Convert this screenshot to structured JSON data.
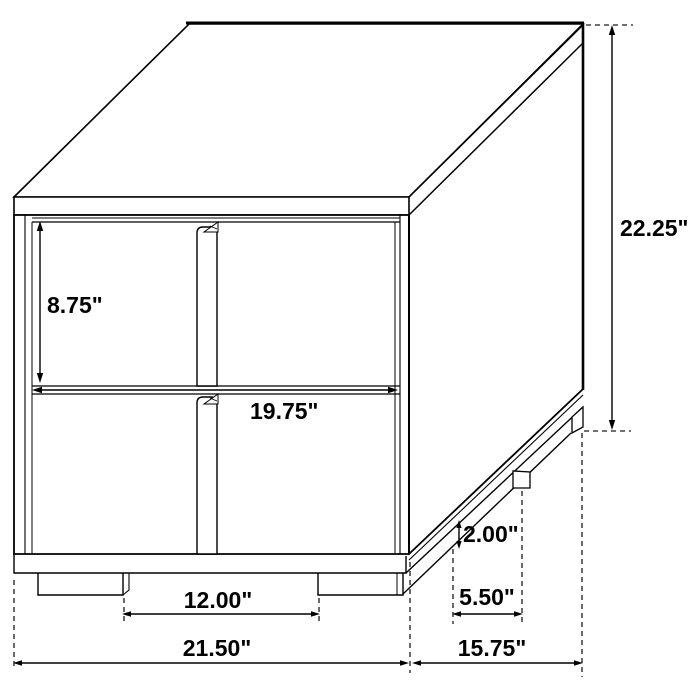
{
  "page": {
    "background_color": "#ffffff",
    "ink_color": "#000000"
  },
  "drawing": {
    "subject": "Two-drawer nightstand isometric line drawing with dimensions",
    "dimensions": {
      "drawer_front_height": "8.75\"",
      "overall_height": "22.25\"",
      "drawer_width": "19.75\"",
      "base_height": "2.00\"",
      "side_leg_setback": "5.50\"",
      "front_leg_spacing": "12.00\"",
      "overall_width": "21.50\"",
      "overall_depth": "15.75\""
    }
  }
}
